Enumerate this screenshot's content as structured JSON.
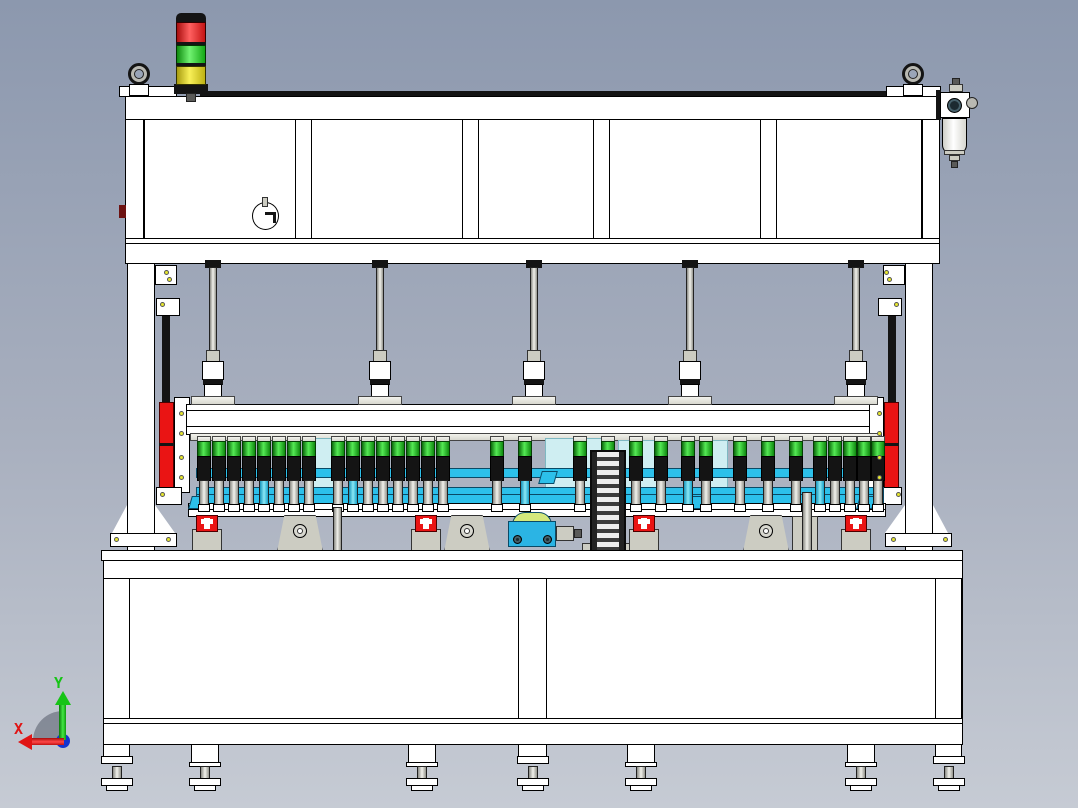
{
  "scene": {
    "description": "CAD front view of a multi-spindle press / assembly machine on a welded table frame",
    "view": "front orthographic"
  },
  "axis_triad": {
    "x_label": "X",
    "y_label": "Y"
  },
  "palette": {
    "bg_top": "#8c98ae",
    "bg_bottom": "#c6cbd4",
    "white": "#ffffff",
    "outline": "#000000",
    "black_part": "#141414",
    "metal_light": "#f2f2ec",
    "metal_dark": "#d8d8d0",
    "pale_cyan": "#cfeef2",
    "cyan": "#2cc0ea",
    "cyan_dark": "#0a4a66",
    "red": "#ea1414",
    "dark_red": "#6d1212",
    "lamp_red": "#e01818",
    "lamp_green": "#35dd35",
    "lamp_yellow": "#e8dc28",
    "bolt_yellow": "#e6e62e",
    "gray": "#ccccc2",
    "dark_gray": "#5a5a58",
    "pump_blue": "#2bb4e4",
    "pump_arch": "#d4e87c",
    "axis_red": "#e01414",
    "axis_green": "#16c416",
    "axis_origin": "#1434d0"
  },
  "tower_light": {
    "segments": [
      {
        "name": "tower-segment-red",
        "color_key": "lamp_red"
      },
      {
        "name": "tower-segment-green",
        "color_key": "lamp_green"
      },
      {
        "name": "tower-segment-yellow",
        "color_key": "lamp_yellow"
      }
    ]
  },
  "parts_back": [
    [
      "top-rear-strip",
      200,
      91,
      740,
      6,
      "blk",
      0
    ],
    [
      "top-beam",
      125,
      96,
      815,
      24,
      "w",
      1
    ],
    [
      "lift-block-left",
      119,
      86,
      58,
      11,
      "w",
      1
    ],
    [
      "lift-block-right",
      886,
      86,
      55,
      11,
      "w",
      1
    ],
    [
      "frame-body-panel",
      125,
      119,
      815,
      120,
      "w",
      1
    ],
    [
      "frame-inner-edge-left",
      143,
      119,
      2,
      120,
      "line",
      0
    ],
    [
      "frame-inner-edge-right",
      921,
      119,
      2,
      120,
      "line",
      0
    ],
    [
      "frame-bottom-bar",
      125,
      238,
      815,
      26,
      "w",
      1
    ],
    [
      "frame-bottom-line",
      125,
      243,
      815,
      1,
      "line",
      0
    ],
    [
      "gauge-body",
      252,
      202,
      27,
      28,
      "circlew",
      1
    ],
    [
      "gauge-tab",
      262,
      197,
      6,
      10,
      "gray",
      0
    ],
    [
      "gauge-mark-h",
      265,
      212,
      11,
      3,
      "blk",
      0
    ],
    [
      "gauge-mark-v",
      273,
      212,
      3,
      11,
      "blk",
      0
    ],
    [
      "side-nub",
      119,
      205,
      7,
      13,
      "darkred",
      1
    ],
    [
      "tower-cap",
      176,
      13,
      30,
      10,
      "blkr",
      1
    ],
    [
      "tower-base",
      174,
      84,
      34,
      10,
      "blk",
      1
    ],
    [
      "tower-pole",
      186,
      93,
      10,
      9,
      "dgray",
      0
    ],
    [
      "filter-bracket",
      936,
      90,
      5,
      30,
      "blk",
      0
    ],
    [
      "filter-nipple",
      952,
      78,
      8,
      8,
      "dgray",
      0
    ],
    [
      "filter-nipple-cap",
      949,
      84,
      14,
      8,
      "gray",
      0
    ],
    [
      "filter-head",
      940,
      92,
      30,
      26,
      "w",
      1
    ],
    [
      "filter-head-screw",
      947,
      98,
      15,
      15,
      "circledark",
      1
    ],
    [
      "filter-knob",
      966,
      97,
      12,
      12,
      "circlegray",
      1
    ],
    [
      "filter-bowl",
      942,
      118,
      25,
      36,
      "wrb",
      1
    ],
    [
      "filter-ring",
      944,
      150,
      21,
      5,
      "gray",
      0
    ],
    [
      "filter-fitting-1",
      949,
      155,
      11,
      6,
      "gray",
      0
    ],
    [
      "filter-fitting-2",
      951,
      161,
      7,
      7,
      "dgray",
      0
    ]
  ],
  "columns": [
    [
      "column-left",
      127,
      263,
      28,
      290,
      "w",
      1
    ],
    [
      "column-left-top-bracket",
      155,
      265,
      22,
      20,
      "w",
      0
    ],
    [
      "column-left-gusset-inner",
      112,
      505,
      15,
      28,
      "wtriL",
      0
    ],
    [
      "column-left-gusset-outer",
      155,
      505,
      20,
      28,
      "wtriR",
      0
    ],
    [
      "column-left-foot",
      110,
      533,
      67,
      14,
      "w",
      1
    ],
    [
      "column-right",
      905,
      263,
      28,
      290,
      "w",
      1
    ],
    [
      "column-right-top-bracket",
      883,
      265,
      22,
      20,
      "w",
      0
    ],
    [
      "column-right-gusset-inner",
      885,
      505,
      20,
      28,
      "wtriL",
      0
    ],
    [
      "column-right-gusset-outer",
      933,
      505,
      15,
      28,
      "wtriR",
      0
    ],
    [
      "column-right-foot",
      885,
      533,
      67,
      14,
      "w",
      1
    ]
  ],
  "rails": [
    [
      "guide-rail-left",
      162,
      316,
      8,
      186,
      "blk",
      1
    ],
    [
      "carriage-left",
      159,
      402,
      15,
      88,
      "redpart",
      1
    ],
    [
      "carriage-left-split",
      159,
      443,
      15,
      3,
      "blk",
      0
    ],
    [
      "rail-plate-left",
      174,
      397,
      16,
      96,
      "w",
      0
    ],
    [
      "rail-bracket-top-left",
      156,
      298,
      24,
      18,
      "w",
      0
    ],
    [
      "rail-bracket-bottom-left",
      156,
      487,
      26,
      18,
      "w",
      0
    ],
    [
      "guide-rail-right",
      888,
      316,
      8,
      186,
      "blk",
      1
    ],
    [
      "carriage-right",
      884,
      402,
      15,
      88,
      "redpart",
      1
    ],
    [
      "carriage-right-split",
      884,
      443,
      15,
      3,
      "blk",
      0
    ],
    [
      "rail-plate-right",
      868,
      397,
      16,
      96,
      "w",
      0
    ],
    [
      "rail-bracket-top-right",
      878,
      298,
      24,
      18,
      "w",
      0
    ],
    [
      "rail-bracket-bottom-right",
      876,
      487,
      26,
      18,
      "w",
      0
    ]
  ],
  "bolt_dots": [
    [
      114,
      537
    ],
    [
      166,
      537
    ],
    [
      164,
      270
    ],
    [
      167,
      277
    ],
    [
      891,
      537
    ],
    [
      943,
      537
    ],
    [
      884,
      270
    ],
    [
      887,
      277
    ],
    [
      179,
      411
    ],
    [
      179,
      431
    ],
    [
      179,
      455
    ],
    [
      179,
      475
    ],
    [
      877,
      411
    ],
    [
      877,
      431
    ],
    [
      877,
      455
    ],
    [
      877,
      475
    ],
    [
      160,
      302
    ],
    [
      160,
      492
    ],
    [
      894,
      302
    ],
    [
      896,
      492
    ]
  ],
  "beam": [
    [
      "press-beam",
      186,
      404,
      684,
      31,
      "w",
      1
    ],
    [
      "press-beam-line-top",
      186,
      410,
      684,
      1,
      "line",
      0
    ],
    [
      "press-beam-line-bottom",
      186,
      426,
      684,
      1,
      "line",
      0
    ]
  ],
  "spindles": {
    "x_centers": [
      213,
      380,
      534,
      690,
      856
    ]
  },
  "press_zone": [
    [
      "cylinder-rail",
      190,
      433,
      692,
      8,
      "metal",
      0
    ],
    [
      "backdrop-pale-1",
      312,
      438,
      26,
      64,
      "pale",
      0
    ],
    [
      "backdrop-pale-2",
      545,
      438,
      58,
      64,
      "pale",
      0
    ],
    [
      "backdrop-pale-3",
      618,
      440,
      42,
      60,
      "pale",
      0
    ],
    [
      "backdrop-pale-4",
      704,
      440,
      24,
      60,
      "pale",
      0
    ],
    [
      "conveyor-bar-upper",
      196,
      468,
      688,
      10,
      "cyan",
      1
    ],
    [
      "conveyor-bar-lower",
      196,
      487,
      688,
      17,
      "cyan",
      1
    ],
    [
      "conveyor-bar-line",
      196,
      494,
      688,
      1,
      "cyanline",
      0
    ],
    [
      "fixture-plate",
      188,
      503,
      698,
      14,
      "w",
      1
    ],
    [
      "fixture-plate-line",
      188,
      509,
      698,
      1,
      "line",
      0
    ]
  ],
  "cyan_wedges": [
    [
      190,
      496
    ],
    [
      540,
      471
    ],
    [
      688,
      496
    ],
    [
      858,
      496
    ]
  ],
  "cylinders": {
    "x_centers": [
      204,
      219,
      234,
      249,
      264,
      279,
      294,
      309,
      338,
      353,
      368,
      383,
      398,
      413,
      428,
      443,
      497,
      525,
      580,
      608,
      636,
      661,
      688,
      706,
      740,
      768,
      796,
      820,
      835,
      850,
      864,
      878
    ],
    "cyan_rods": [
      264,
      353,
      525,
      688,
      820
    ]
  },
  "under_plate": [
    [
      "tool-block",
      792,
      516,
      26,
      36,
      "gray",
      1
    ],
    [
      "silver-post-1",
      333,
      507,
      9,
      45,
      "metalv",
      0
    ],
    [
      "silver-post-2",
      802,
      492,
      10,
      60,
      "metalv",
      0
    ],
    [
      "pump-arch",
      512,
      512,
      40,
      13,
      "arch",
      0
    ],
    [
      "pump-body",
      508,
      521,
      48,
      26,
      "pump",
      1
    ],
    [
      "pump-screw-left",
      513,
      535,
      9,
      9,
      "circledark",
      0
    ],
    [
      "pump-screw-right",
      543,
      535,
      9,
      9,
      "circledark",
      0
    ],
    [
      "pump-motor",
      556,
      526,
      18,
      15,
      "gray",
      0
    ],
    [
      "pump-shaft",
      574,
      529,
      8,
      9,
      "dgray",
      0
    ],
    [
      "chain-base",
      582,
      543,
      52,
      10,
      "gray",
      0
    ],
    [
      "chain",
      590,
      450,
      36,
      102,
      "chain",
      1
    ]
  ],
  "clamps": {
    "x_centers": [
      207,
      426,
      644,
      856
    ]
  },
  "stands": {
    "x_centers": [
      300,
      467,
      766
    ]
  },
  "table": {
    "slabs": [
      [
        "table-top",
        101,
        550,
        862,
        11,
        "w",
        1
      ],
      [
        "table-band",
        103,
        560,
        860,
        19,
        "w",
        1
      ],
      [
        "table-skirt",
        103,
        578,
        860,
        141,
        "w",
        1
      ]
    ],
    "legs": [
      [
        103,
        27
      ],
      [
        518,
        29
      ],
      [
        935,
        27
      ]
    ],
    "rail": [
      "table-rail",
      103,
      718,
      860,
      27,
      "w",
      1
    ],
    "rail_line": [
      "table-rail-line",
      103,
      723,
      860,
      1,
      "line",
      0
    ],
    "leg_feet_x": [
      117,
      533,
      949
    ],
    "mid_feet_x": [
      205,
      422,
      641,
      861
    ]
  },
  "eye_bolts_x": [
    139,
    913
  ]
}
